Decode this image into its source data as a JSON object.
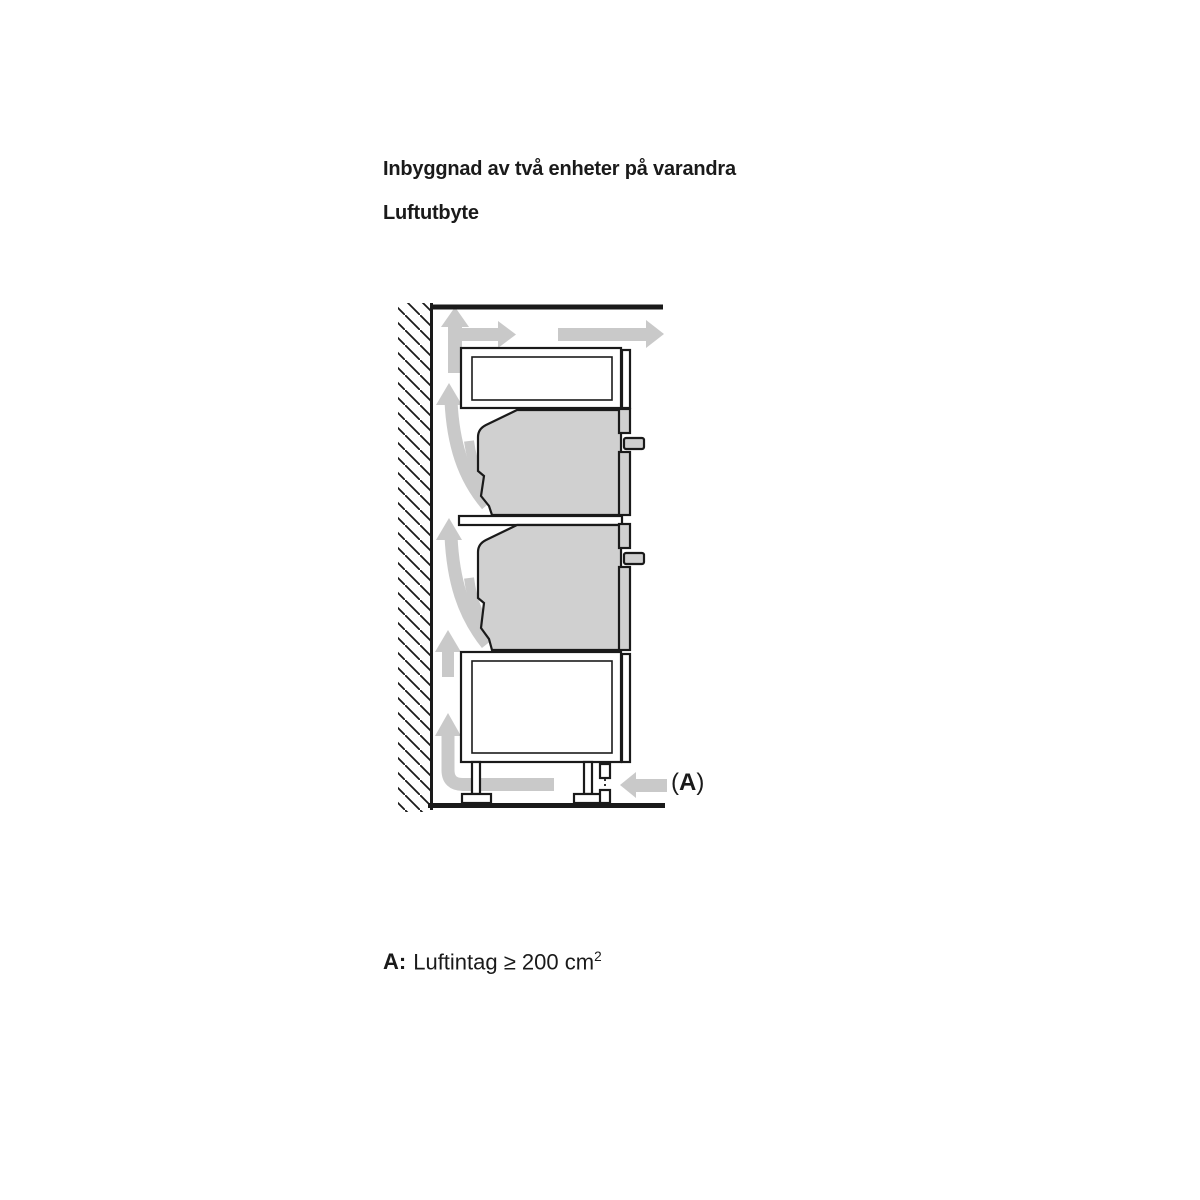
{
  "headings": {
    "title": "Inbyggnad av två enheter på varandra",
    "subtitle": "Luftutbyte"
  },
  "diagram": {
    "label_a": {
      "open": "(",
      "letter": "A",
      "close": ")"
    },
    "colors": {
      "outline": "#1a1a1a",
      "appliance_fill": "#d0d0d0",
      "arrow_fill": "#c9c9c9",
      "background": "#ffffff"
    }
  },
  "caption": {
    "prefix": "A:",
    "text": "Luftintag ≥ 200 cm",
    "superscript": "2"
  }
}
